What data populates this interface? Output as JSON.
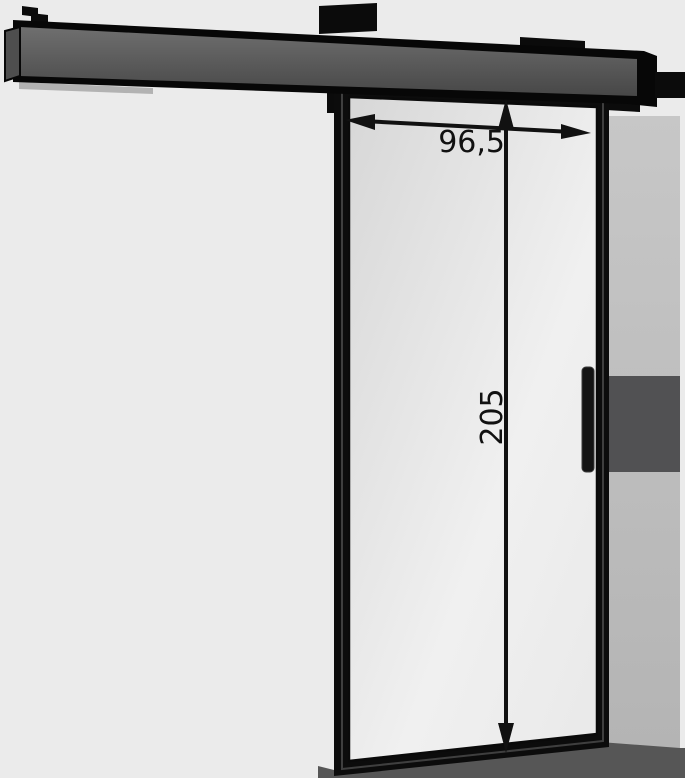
{
  "diagram": {
    "kind": "furniture-dimension-diagram",
    "subject": "wall-mounted sliding door with top rail and vertical handle",
    "dimensions": {
      "width_label": "96,5",
      "height_label": "205"
    },
    "colors": {
      "background": "#ebebeb",
      "dimension_ink": "#111111",
      "frame_black": "#0c0c0c",
      "rail_face_top": "#6f6f6f",
      "rail_face_bottom": "#474747",
      "rail_end_cap": "#4e4e4e",
      "rail_wall_shadow": "#b2b2b2",
      "glass_top_left": "#d7d7d7",
      "glass_mid": "#f0f0f0",
      "glass_bottom_right": "#e9e9e9",
      "wall_band_top": "#c7c7c7",
      "wall_band_bottom": "#b4b4b4",
      "wall_band_dark_block": "#515153",
      "floor_shadow": "#565656"
    }
  }
}
